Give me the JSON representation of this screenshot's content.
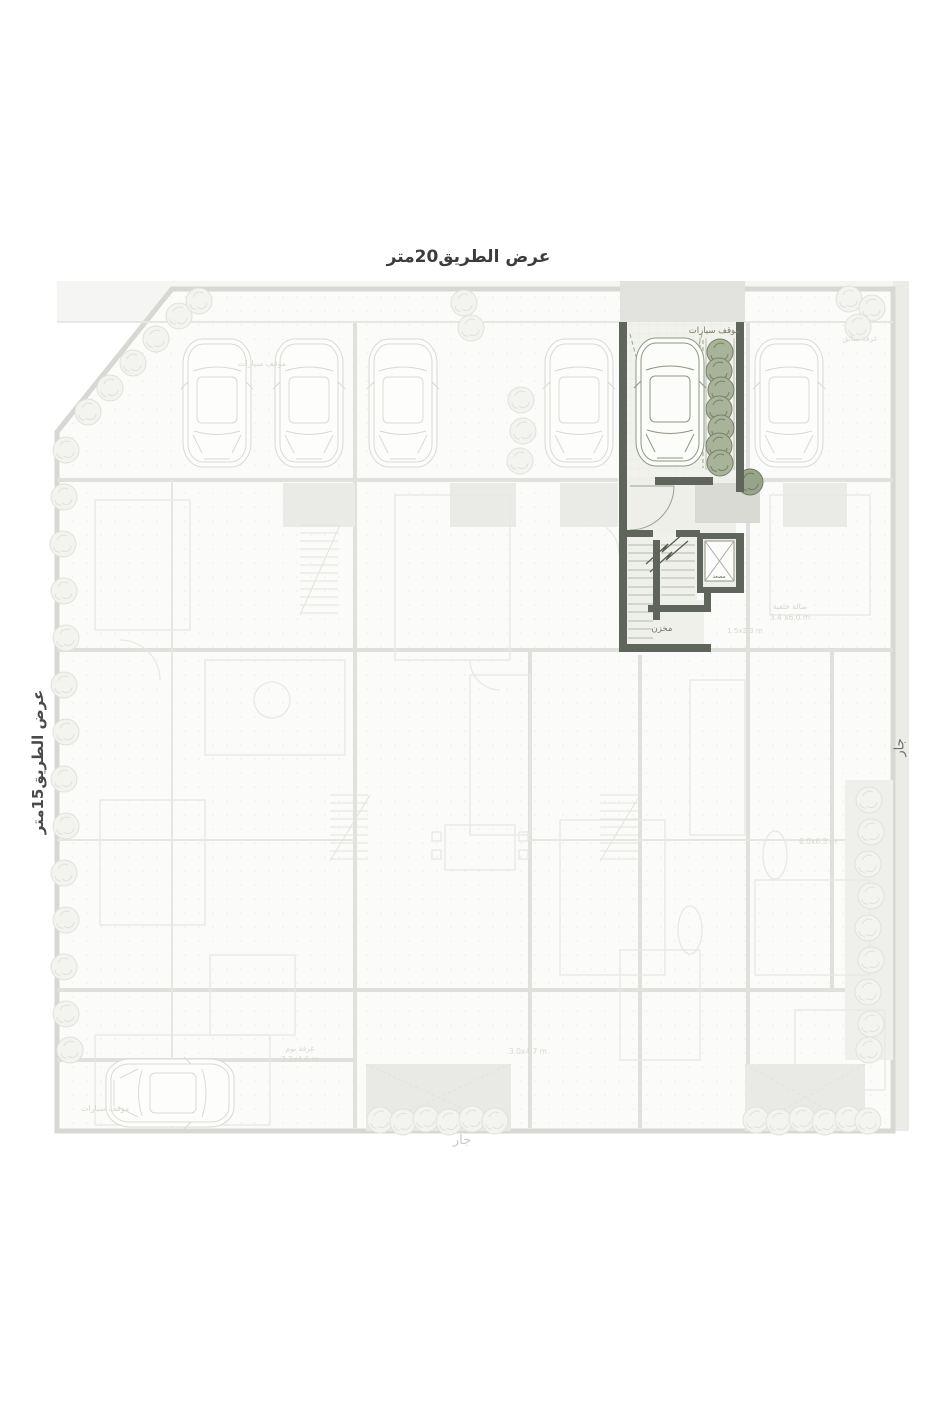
{
  "site_labels": {
    "road_top": "عرض الطريق20متر",
    "road_left": "عرض الطريق15متر",
    "neighbor_right": "جار",
    "neighbor_bottom": "جار"
  },
  "unit": {
    "parking_label": "موقف سيارات",
    "elevator_label": "مصعد",
    "storage_label": "مخزن"
  },
  "faded_labels": [
    {
      "text": "موقف سيارات"
    },
    {
      "text": "غرفة سائق"
    },
    {
      "text": "صالة خلفية"
    },
    {
      "text": "3.4 x6.0 m"
    },
    {
      "text": "غرفة نوم"
    },
    {
      "text": "3.2x4.6 m"
    },
    {
      "text": "موقف سيارات"
    },
    {
      "text": "1.5x2.3 m"
    },
    {
      "text": "3.0x4.7 m"
    },
    {
      "text": "6.0x6.3 m"
    }
  ],
  "colors": {
    "highlight_wall": "#60655b",
    "highlight_floor": "#f1f2ec",
    "road_strip": "#e2e3df",
    "tree_fill": "#a8b399",
    "tree_outline": "#76826a",
    "faded_line": "#e0e0dc",
    "label_dark": "#3c3c3c"
  }
}
